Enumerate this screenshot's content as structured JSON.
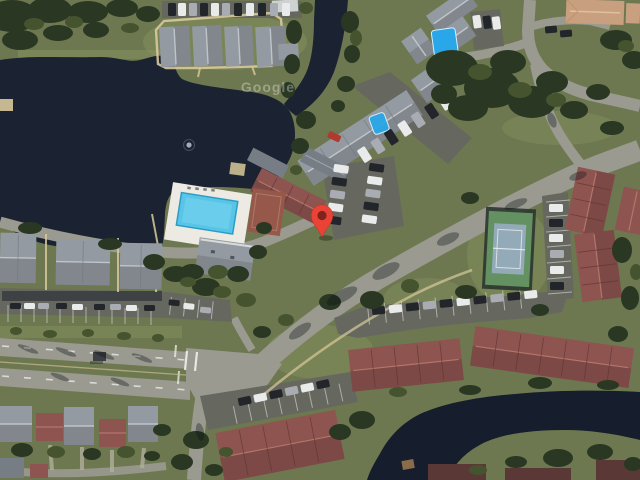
{
  "app": {
    "type": "satellite-map-view"
  },
  "watermark": {
    "text": "Google",
    "color": "#ffffff",
    "opacity": 0.32
  },
  "marker": {
    "x": 322,
    "y": 237,
    "color": "#EA4335",
    "inner_color": "#7C241D"
  },
  "palette": {
    "grass": "#6d7850",
    "grass_light": "#87925e",
    "trees_dark": "#2a3823",
    "trees_mid": "#45532f",
    "water": "#1b2232",
    "water2": "#161d2c",
    "road": "#9a9a90",
    "asphalt": "#66685f",
    "roof_gray": "#939aa1",
    "roof_gray_dark": "#767d85",
    "roof_red": "#8e5450",
    "roof_red_dark": "#5a3835",
    "roof_tan": "#c9a07f",
    "path_tan": "#d8c99b",
    "pool_deck": "#eceae2",
    "pool_water": "#56c5e8",
    "pool_bright": "#29a7e8",
    "court_green": "#639161",
    "court_blue": "#93abb9",
    "court_red": "#96584a",
    "car_white": "#e9eaea",
    "car_dark": "#22262b",
    "car_silver": "#a9adb3",
    "car_red": "#b03a30",
    "line_white": "#f5f5f5"
  },
  "features": [
    {
      "name": "lake",
      "kind": "water"
    },
    {
      "name": "channel-arm",
      "kind": "water"
    },
    {
      "name": "canal",
      "kind": "water"
    },
    {
      "name": "fountain",
      "kind": "water-feature"
    },
    {
      "name": "community-pool",
      "kind": "amenity"
    },
    {
      "name": "courtyard-pool",
      "kind": "amenity"
    },
    {
      "name": "small-blue-pool",
      "kind": "amenity"
    },
    {
      "name": "tennis-court",
      "kind": "amenity"
    },
    {
      "name": "shuffleboard-court",
      "kind": "amenity"
    },
    {
      "name": "clubhouse",
      "kind": "building"
    },
    {
      "name": "gray-roof-apartments",
      "kind": "building"
    },
    {
      "name": "red-roof-townhouses",
      "kind": "building"
    },
    {
      "name": "tan-roof-building",
      "kind": "building"
    },
    {
      "name": "single-family-homes",
      "kind": "building"
    },
    {
      "name": "boulevard",
      "kind": "road"
    },
    {
      "name": "curved-collector-road",
      "kind": "road"
    },
    {
      "name": "parking-lots",
      "kind": "parking"
    },
    {
      "name": "bus-shelter",
      "kind": "street-furniture"
    },
    {
      "name": "docks",
      "kind": "structure"
    }
  ]
}
